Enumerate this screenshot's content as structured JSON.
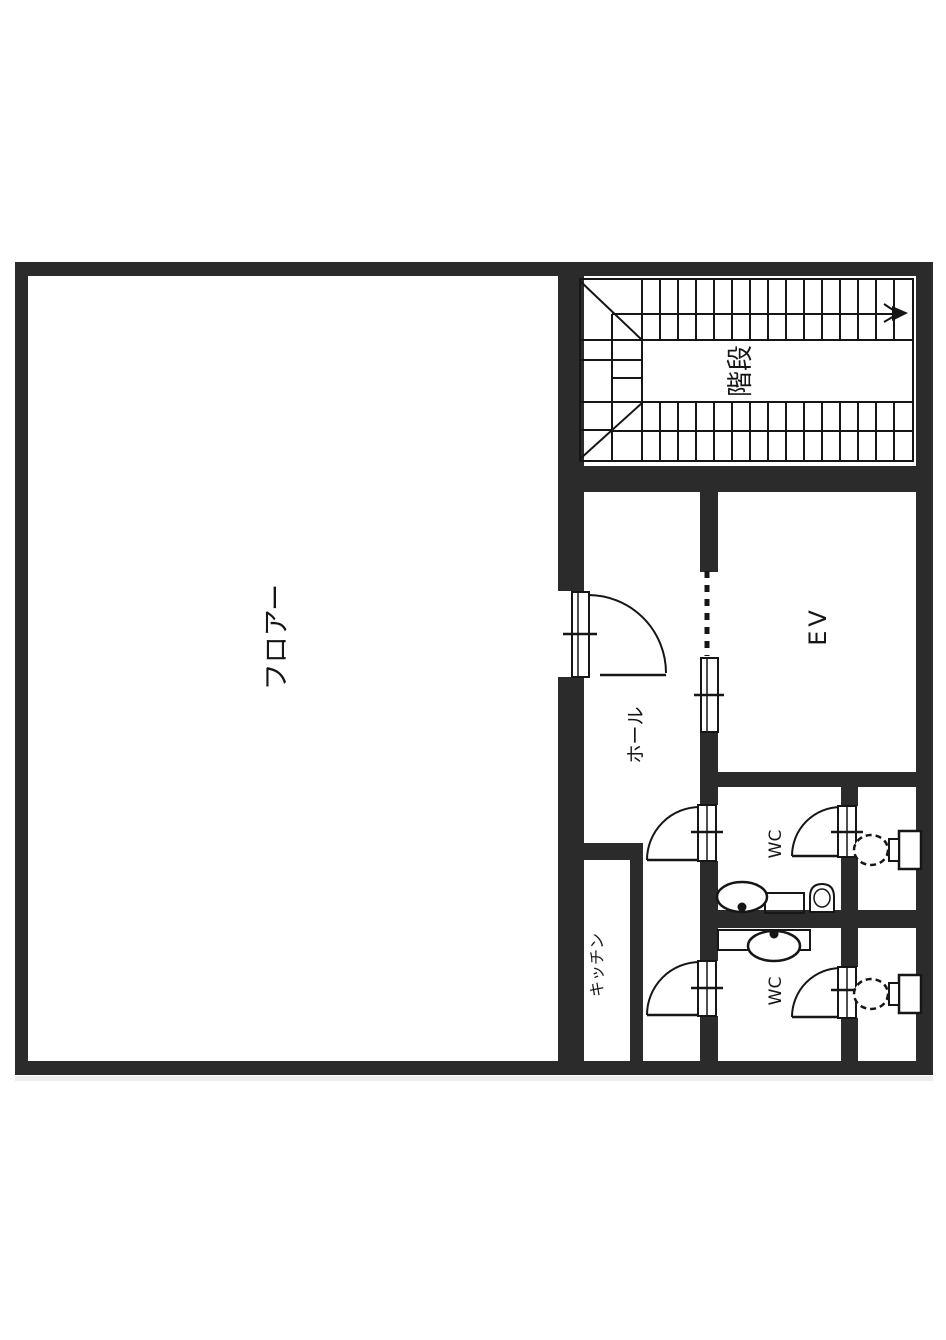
{
  "plan": {
    "background_color": "#ffffff",
    "wall_color": "#2b2b2b",
    "line_color": "#161616",
    "labels": {
      "floor": "フロアー",
      "stairs": "階段",
      "hall": "ホール",
      "elevator": "EV",
      "wc_upper": "WC",
      "wc_lower": "WC",
      "kitchen": "キッチン"
    }
  }
}
